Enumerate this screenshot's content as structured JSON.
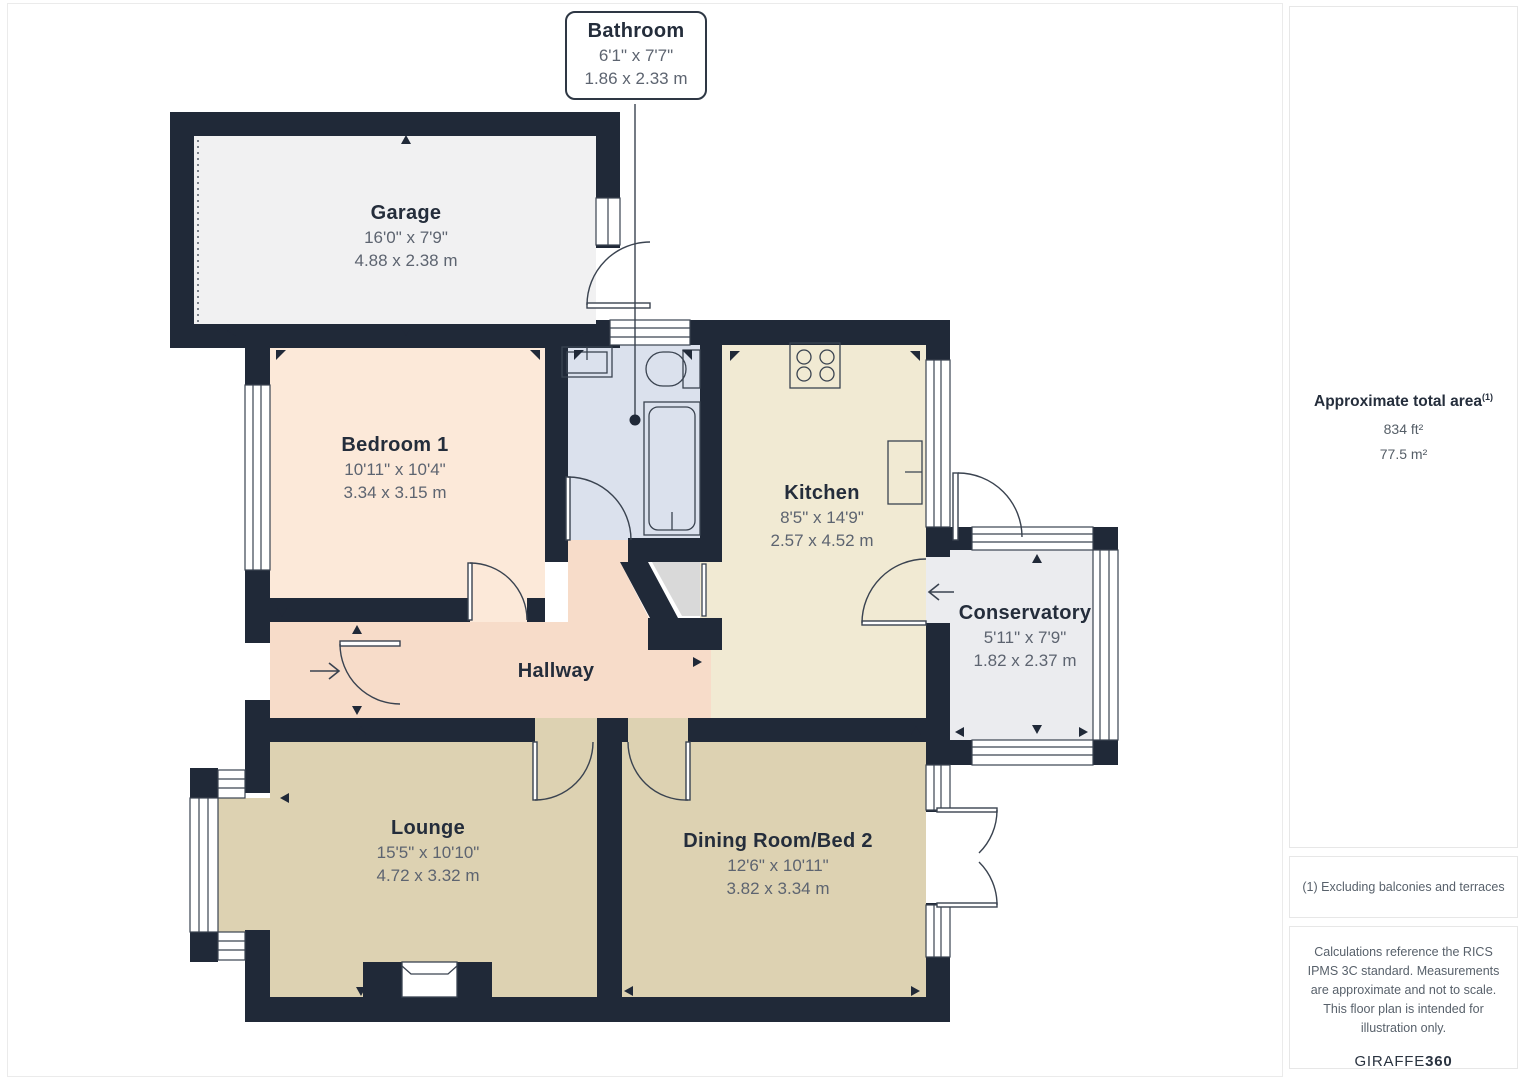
{
  "plan": {
    "callout": {
      "name": "Bathroom",
      "imperial": "6'1\" x 7'7\"",
      "metric": "1.86 x 2.33 m"
    },
    "rooms": {
      "garage": {
        "name": "Garage",
        "imperial": "16'0\" x 7'9\"",
        "metric": "4.88 x 2.38 m"
      },
      "bedroom1": {
        "name": "Bedroom 1",
        "imperial": "10'11\" x 10'4\"",
        "metric": "3.34 x 3.15 m"
      },
      "kitchen": {
        "name": "Kitchen",
        "imperial": "8'5\" x 14'9\"",
        "metric": "2.57 x 4.52 m"
      },
      "conservatory": {
        "name": "Conservatory",
        "imperial": "5'11\" x 7'9\"",
        "metric": "1.82 x 2.37 m"
      },
      "hallway": {
        "name": "Hallway"
      },
      "lounge": {
        "name": "Lounge",
        "imperial": "15'5\" x 10'10\"",
        "metric": "4.72 x 3.32 m"
      },
      "dining": {
        "name": "Dining Room/Bed 2",
        "imperial": "12'6\" x 10'11\"",
        "metric": "3.82 x 3.34 m"
      }
    }
  },
  "sidebar": {
    "total_area_label": "Approximate total area",
    "total_area_sup": "(1)",
    "area_ft": "834 ft²",
    "area_m": "77.5 m²",
    "footnote": "(1) Excluding balconies and terraces",
    "disclaimer": "Calculations reference the RICS IPMS 3C standard. Measurements are approximate and not to scale. This floor plan is intended for illustration only.",
    "brand_name": "GIRAFFE",
    "brand_number": "360"
  },
  "colors": {
    "wall": "#202938",
    "line": "#3a4350",
    "floor_garage": "#f1f1f2",
    "floor_bedroom": "#fce9d9",
    "floor_bathroom": "#dbe1ed",
    "floor_kitchen": "#f1ead3",
    "floor_hallway": "#f7dcc9",
    "floor_lounge": "#ddd2b2",
    "floor_dining": "#ddd2b2",
    "floor_conservatory": "#ebecef",
    "floor_cupboard": "#d9d9d9"
  }
}
